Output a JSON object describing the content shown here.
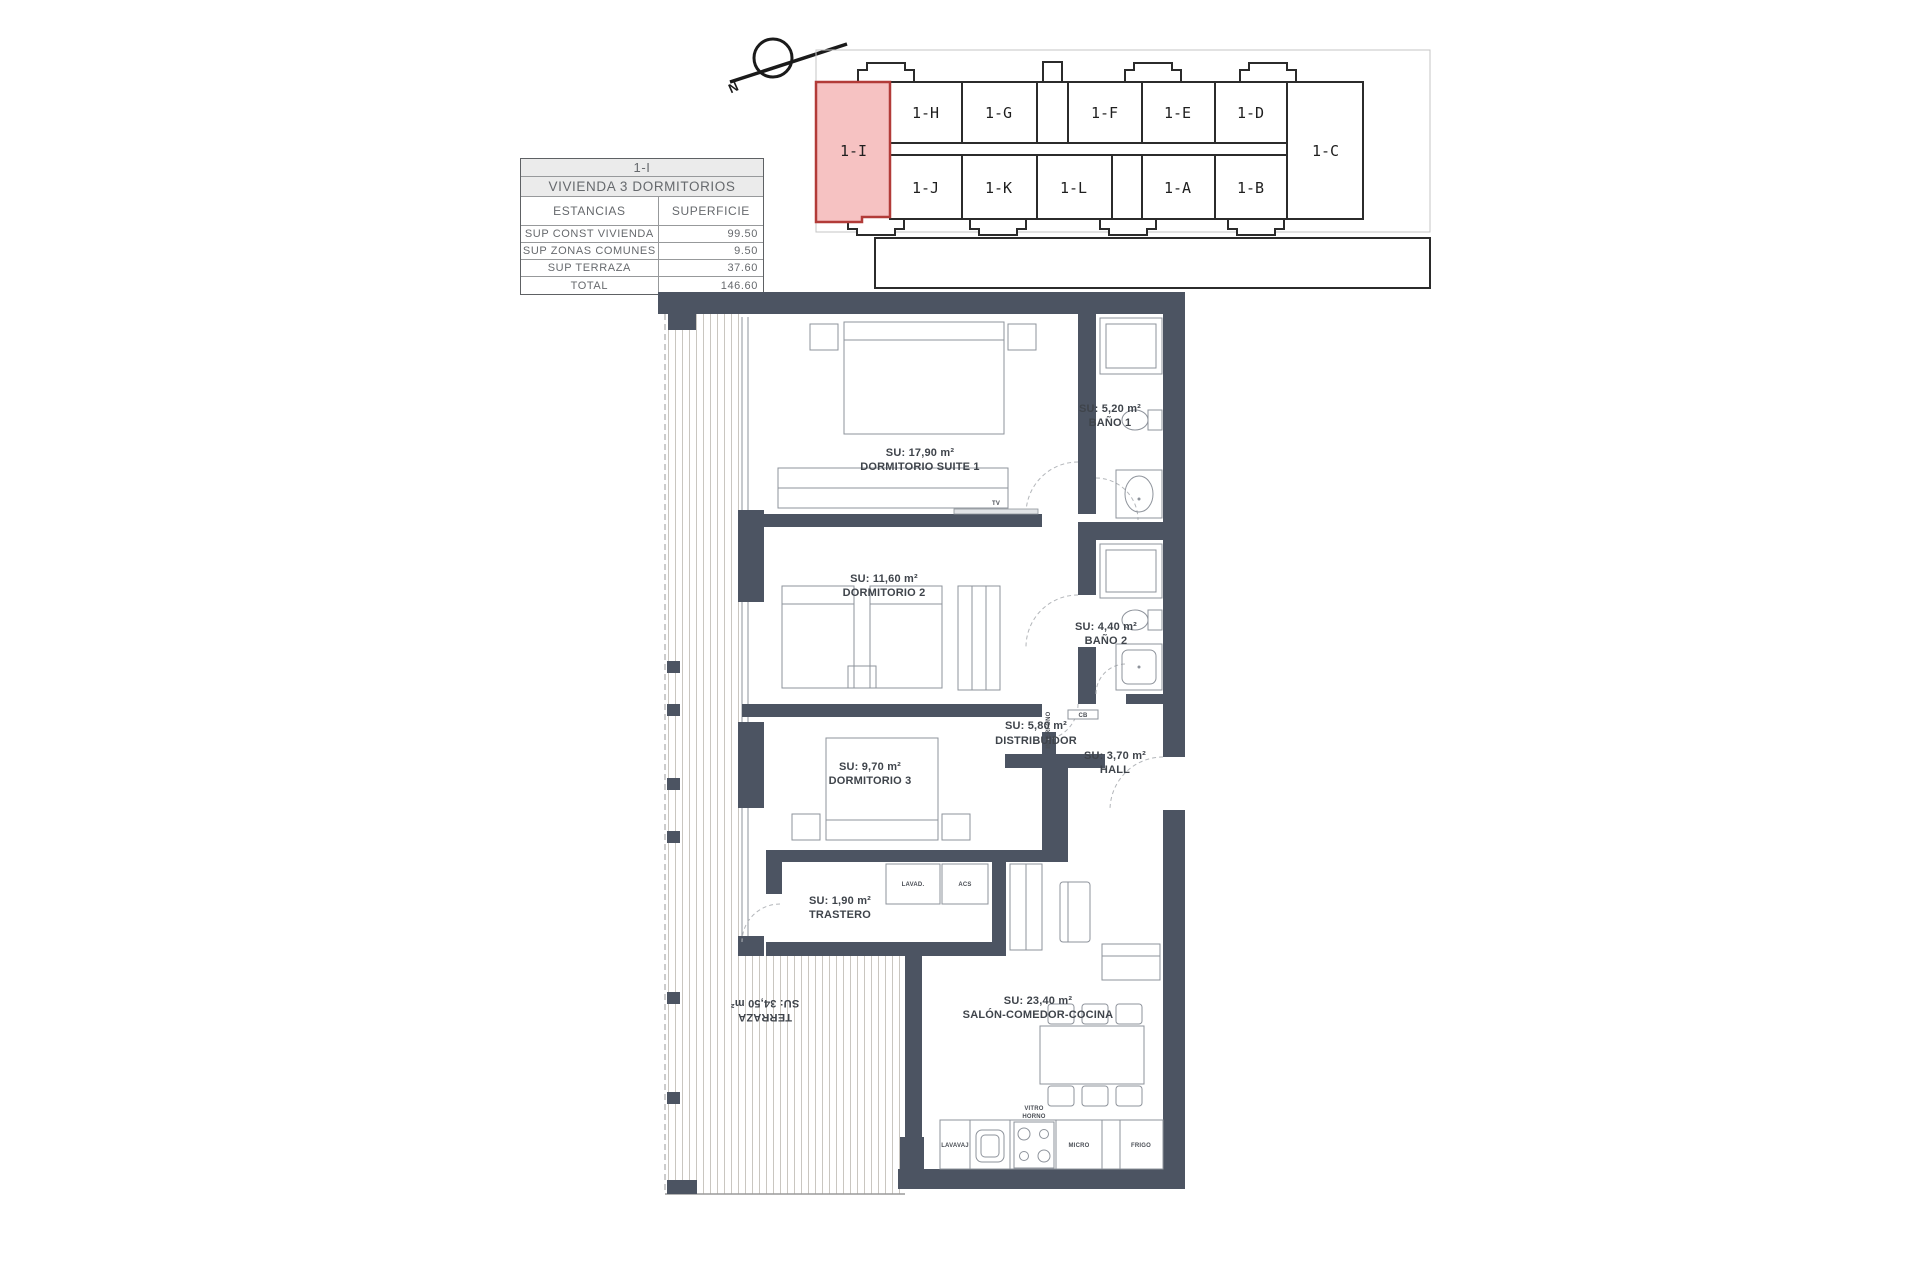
{
  "summary_table": {
    "unit": "1-I",
    "dwelling_type": "VIVIENDA 3 DORMITORIOS",
    "columns": {
      "estancias": "ESTANCIAS",
      "superficie": "SUPERFICIE"
    },
    "rows": [
      {
        "label": "SUP CONST VIVIENDA",
        "value": "99.50"
      },
      {
        "label": "SUP ZONAS COMUNES",
        "value": "9.50"
      },
      {
        "label": "SUP TERRAZA",
        "value": "37.60"
      },
      {
        "label": "TOTAL",
        "value": "146.60"
      }
    ]
  },
  "compass": {
    "north_label": "N"
  },
  "key_plan": {
    "highlighted_unit": "1-I",
    "top_row_units": [
      "1-H",
      "1-G",
      "1-F",
      "1-E",
      "1-D"
    ],
    "bottom_row_units": [
      "1-J",
      "1-K",
      "1-L",
      "1-A",
      "1-B"
    ],
    "corner_unit": "1-C",
    "highlight_fill": "#f6c2c2",
    "highlight_stroke": "#b23b38"
  },
  "floor_plan": {
    "wall_color": "#4c5462",
    "rooms": [
      {
        "su": "SU: 17,90 m²",
        "name": "DORMITORIO SUITE 1"
      },
      {
        "su": "SU: 5,20 m²",
        "name": "BAÑO 1"
      },
      {
        "su": "SU: 11,60 m²",
        "name": "DORMITORIO 2"
      },
      {
        "su": "SU: 4,40 m²",
        "name": "BAÑO 2"
      },
      {
        "su": "SU: 5,80 m²",
        "name": "DISTRIBUIDOR"
      },
      {
        "su": "SU: 3,70 m²",
        "name": "HALL"
      },
      {
        "su": "SU: 9,70 m²",
        "name": "DORMITORIO 3"
      },
      {
        "su": "SU: 1,90 m²",
        "name": "TRASTERO"
      },
      {
        "su": "SU: 23,40 m²",
        "name": "SALÓN-COMEDOR-COCINA"
      },
      {
        "su": "SU: 34,50 m²",
        "name": "TERRAZA"
      }
    ],
    "fixture_labels": {
      "tv": "TV",
      "interfono": "INTERFONO",
      "cb": "CB",
      "lavadero": "LAVAD.",
      "acs": "ACS",
      "lavavajillas": "LAVAVAJ",
      "vitro": "VITRO",
      "horno": "HORNO",
      "micro": "MICRO",
      "frigo": "FRIGO"
    }
  }
}
